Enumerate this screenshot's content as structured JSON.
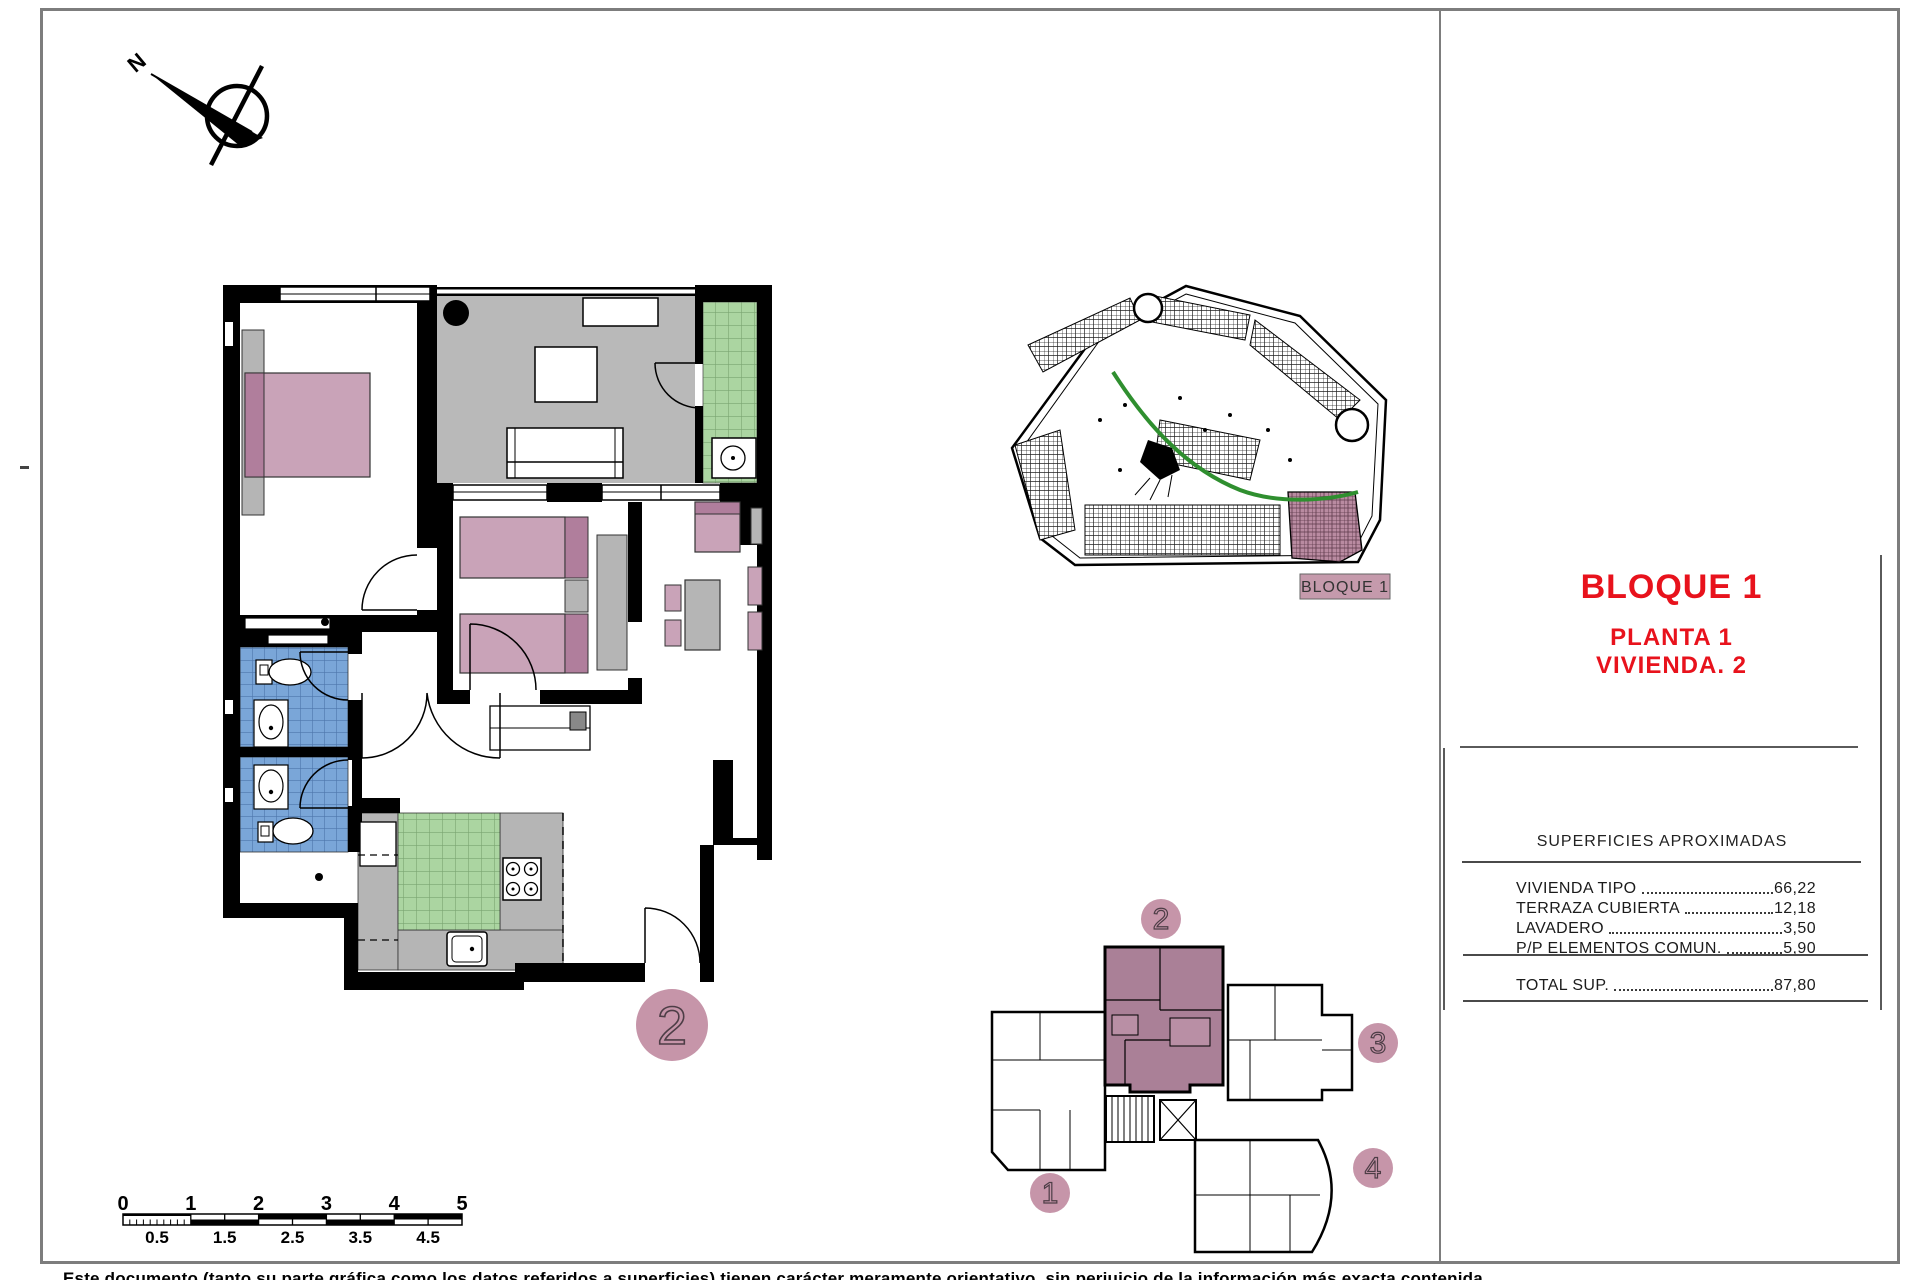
{
  "title_block": {
    "block_label": "BLOQUE 1",
    "floor_label": "PLANTA 1",
    "unit_label": "VIVIENDA. 2"
  },
  "areas_table": {
    "title": "SUPERFICIES APROXIMADAS",
    "rows": [
      {
        "label": "VIVIENDA TIPO",
        "value": "66,22"
      },
      {
        "label": "TERRAZA CUBIERTA",
        "value": "12,18"
      },
      {
        "label": "LAVADERO",
        "value": "3,50"
      },
      {
        "label": "P/P ELEMENTOS COMUN.",
        "value": "5,90"
      }
    ],
    "total": {
      "label": "TOTAL SUP.",
      "value": "87,80"
    }
  },
  "main_plan": {
    "unit_number": "2"
  },
  "key_plan": {
    "unit_1": "1",
    "unit_2": "2",
    "unit_3": "3",
    "unit_4": "4"
  },
  "site_plan": {
    "label": "BLOQUE 1"
  },
  "compass": {
    "north_label": "N"
  },
  "scale_bar": {
    "major": [
      "0",
      "1",
      "2",
      "3",
      "4",
      "5"
    ],
    "minor": [
      "0.5",
      "1.5",
      "2.5",
      "3.5",
      "4.5"
    ]
  },
  "disclaimer": "Este documento (tanto su parte gráfica como los datos referidos a superficies) tienen carácter meramente orientativo, sin perjuicio de la información más exacta contenida.",
  "colors": {
    "accent_red": "#e8121c",
    "wall_black": "#000000",
    "terrace_gray": "#b9b9b9",
    "furniture_gray": "#b5b5b5",
    "bed_pink": "#c9a3b8",
    "bed_dark_pink": "#b07e9c",
    "tile_blue": "#7aa6d8",
    "tile_blue_line": "#4d76ab",
    "tile_green": "#abd5a1",
    "tile_green_line": "#7aa571",
    "badge_pink": "#c695a9",
    "keyplan_highlight": "#aa8097",
    "site_highlight": "#b98ba1",
    "road_green": "#2f8f2f",
    "frame_gray": "#7d7d7d"
  }
}
